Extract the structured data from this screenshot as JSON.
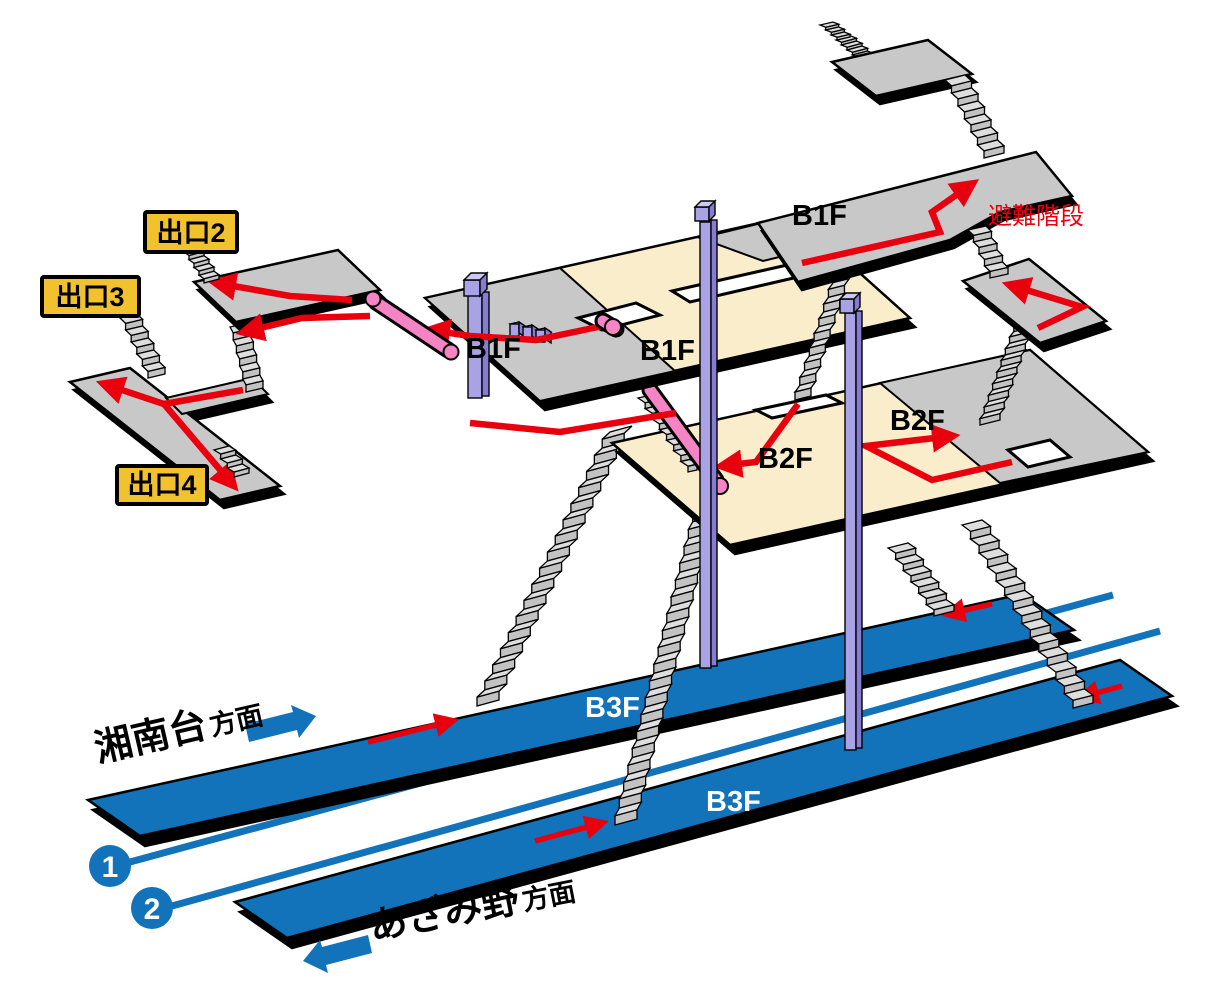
{
  "diagram": {
    "floor_labels": {
      "b1f": "B1F",
      "b2f": "B2F",
      "b3f": "B3F"
    },
    "evacuation_stairs": "避難階段",
    "exits": {
      "exit2": "出口2",
      "exit3": "出口3",
      "exit4": "出口4"
    },
    "directions": {
      "shonandai": {
        "name": "湘南台",
        "suffix": "方面"
      },
      "azamino": {
        "name": "あざみ野",
        "suffix": "方面"
      }
    },
    "tracks": {
      "track1": "1",
      "track2": "2"
    },
    "colors": {
      "platform_blue": "#1272BA",
      "floor_cream": "#FAEDCB",
      "floor_gray": "#C8C8C8",
      "column_purple": "#A9A3E6",
      "escalator_pink": "#F584C4",
      "route_red": "#E8000F",
      "exit_badge_yellow": "#F2C12E"
    }
  }
}
